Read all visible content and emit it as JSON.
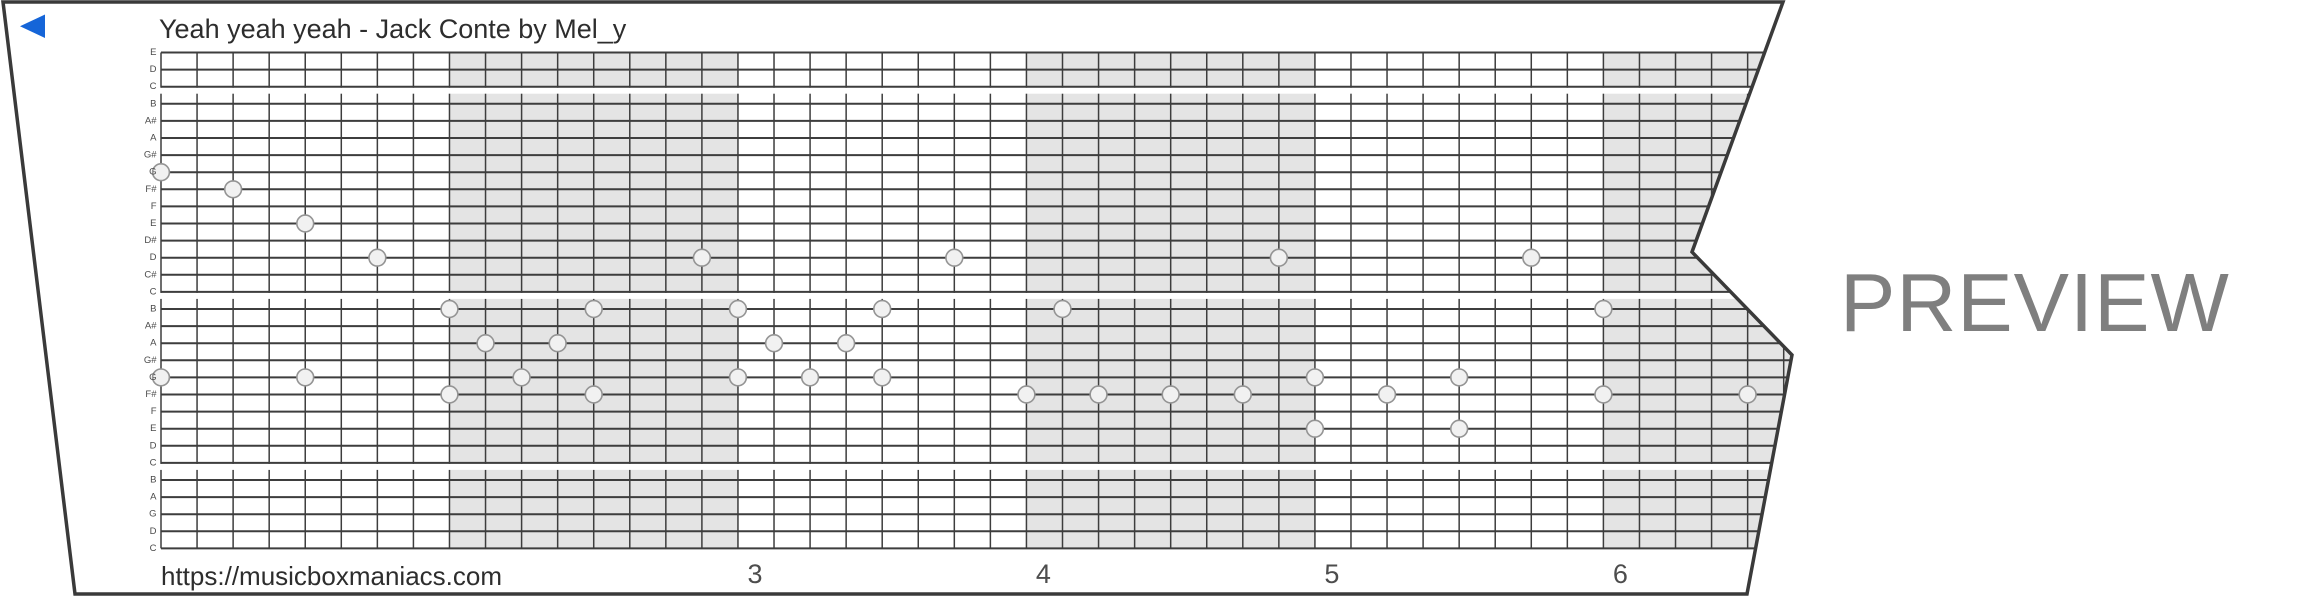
{
  "title": "Yeah yeah yeah - Jack Conte by Mel_y",
  "site_url": "https://musicboxmaniacs.com",
  "watermark": "PREVIEW",
  "play_icon": "back-play-triangle",
  "note_labels_top_to_bottom": [
    "E",
    "D",
    "C",
    "B",
    "A#",
    "A",
    "G#",
    "G",
    "F#",
    "F",
    "E",
    "D#",
    "D",
    "C#",
    "C",
    "B",
    "A#",
    "A",
    "G#",
    "G",
    "F#",
    "F",
    "E",
    "D",
    "C",
    "B",
    "A",
    "G",
    "D",
    "C"
  ],
  "measure_numbers": [
    {
      "label": "3",
      "division": 16
    },
    {
      "label": "4",
      "division": 24
    },
    {
      "label": "5",
      "division": 32
    },
    {
      "label": "6",
      "division": 40
    }
  ],
  "divisions_per_measure": 8,
  "shaded_measures": [
    {
      "start_division": 8,
      "end_division": 16
    },
    {
      "start_division": 24,
      "end_division": 32
    },
    {
      "start_division": 40,
      "end_division": 48
    }
  ],
  "c_stripe_rows": [
    2,
    14,
    24
  ],
  "notes": [
    {
      "pitch": "G",
      "row": 7,
      "col": 0
    },
    {
      "pitch": "G",
      "row": 19,
      "col": 0
    },
    {
      "pitch": "F#",
      "row": 8,
      "col": 2
    },
    {
      "pitch": "E",
      "row": 10,
      "col": 4
    },
    {
      "pitch": "G",
      "row": 19,
      "col": 4
    },
    {
      "pitch": "D",
      "row": 12,
      "col": 6
    },
    {
      "pitch": "B",
      "row": 15,
      "col": 8
    },
    {
      "pitch": "F#",
      "row": 20,
      "col": 8
    },
    {
      "pitch": "A",
      "row": 17,
      "col": 9
    },
    {
      "pitch": "G",
      "row": 19,
      "col": 10
    },
    {
      "pitch": "A",
      "row": 17,
      "col": 11
    },
    {
      "pitch": "B",
      "row": 15,
      "col": 12
    },
    {
      "pitch": "F#",
      "row": 20,
      "col": 12
    },
    {
      "pitch": "D",
      "row": 12,
      "col": 15
    },
    {
      "pitch": "B",
      "row": 15,
      "col": 16
    },
    {
      "pitch": "G",
      "row": 19,
      "col": 16
    },
    {
      "pitch": "A",
      "row": 17,
      "col": 17
    },
    {
      "pitch": "G",
      "row": 19,
      "col": 18
    },
    {
      "pitch": "A",
      "row": 17,
      "col": 19
    },
    {
      "pitch": "B",
      "row": 15,
      "col": 20
    },
    {
      "pitch": "G",
      "row": 19,
      "col": 20
    },
    {
      "pitch": "D",
      "row": 12,
      "col": 22
    },
    {
      "pitch": "F#",
      "row": 20,
      "col": 24
    },
    {
      "pitch": "B",
      "row": 15,
      "col": 25
    },
    {
      "pitch": "F#",
      "row": 20,
      "col": 26
    },
    {
      "pitch": "F#",
      "row": 20,
      "col": 28
    },
    {
      "pitch": "F#",
      "row": 20,
      "col": 30
    },
    {
      "pitch": "D",
      "row": 12,
      "col": 31
    },
    {
      "pitch": "G",
      "row": 19,
      "col": 32
    },
    {
      "pitch": "E",
      "row": 22,
      "col": 32
    },
    {
      "pitch": "F#",
      "row": 20,
      "col": 34
    },
    {
      "pitch": "G",
      "row": 19,
      "col": 36
    },
    {
      "pitch": "E",
      "row": 22,
      "col": 36
    },
    {
      "pitch": "D",
      "row": 12,
      "col": 38
    },
    {
      "pitch": "B",
      "row": 15,
      "col": 40
    },
    {
      "pitch": "F#",
      "row": 20,
      "col": 40
    },
    {
      "pitch": "F#",
      "row": 20,
      "col": 44
    }
  ],
  "colors": {
    "accent_blue": "#1565d8",
    "strip_border": "#3a3a3a",
    "grid_line": "#3d3d3d",
    "measure_shading": "#e4e4e4",
    "note_fill": "#f1f1f1",
    "note_stroke": "#949494",
    "text_dark": "#2d2d2d",
    "text_gray": "#4d4d4d",
    "watermark_gray": "#7f7f7f"
  }
}
